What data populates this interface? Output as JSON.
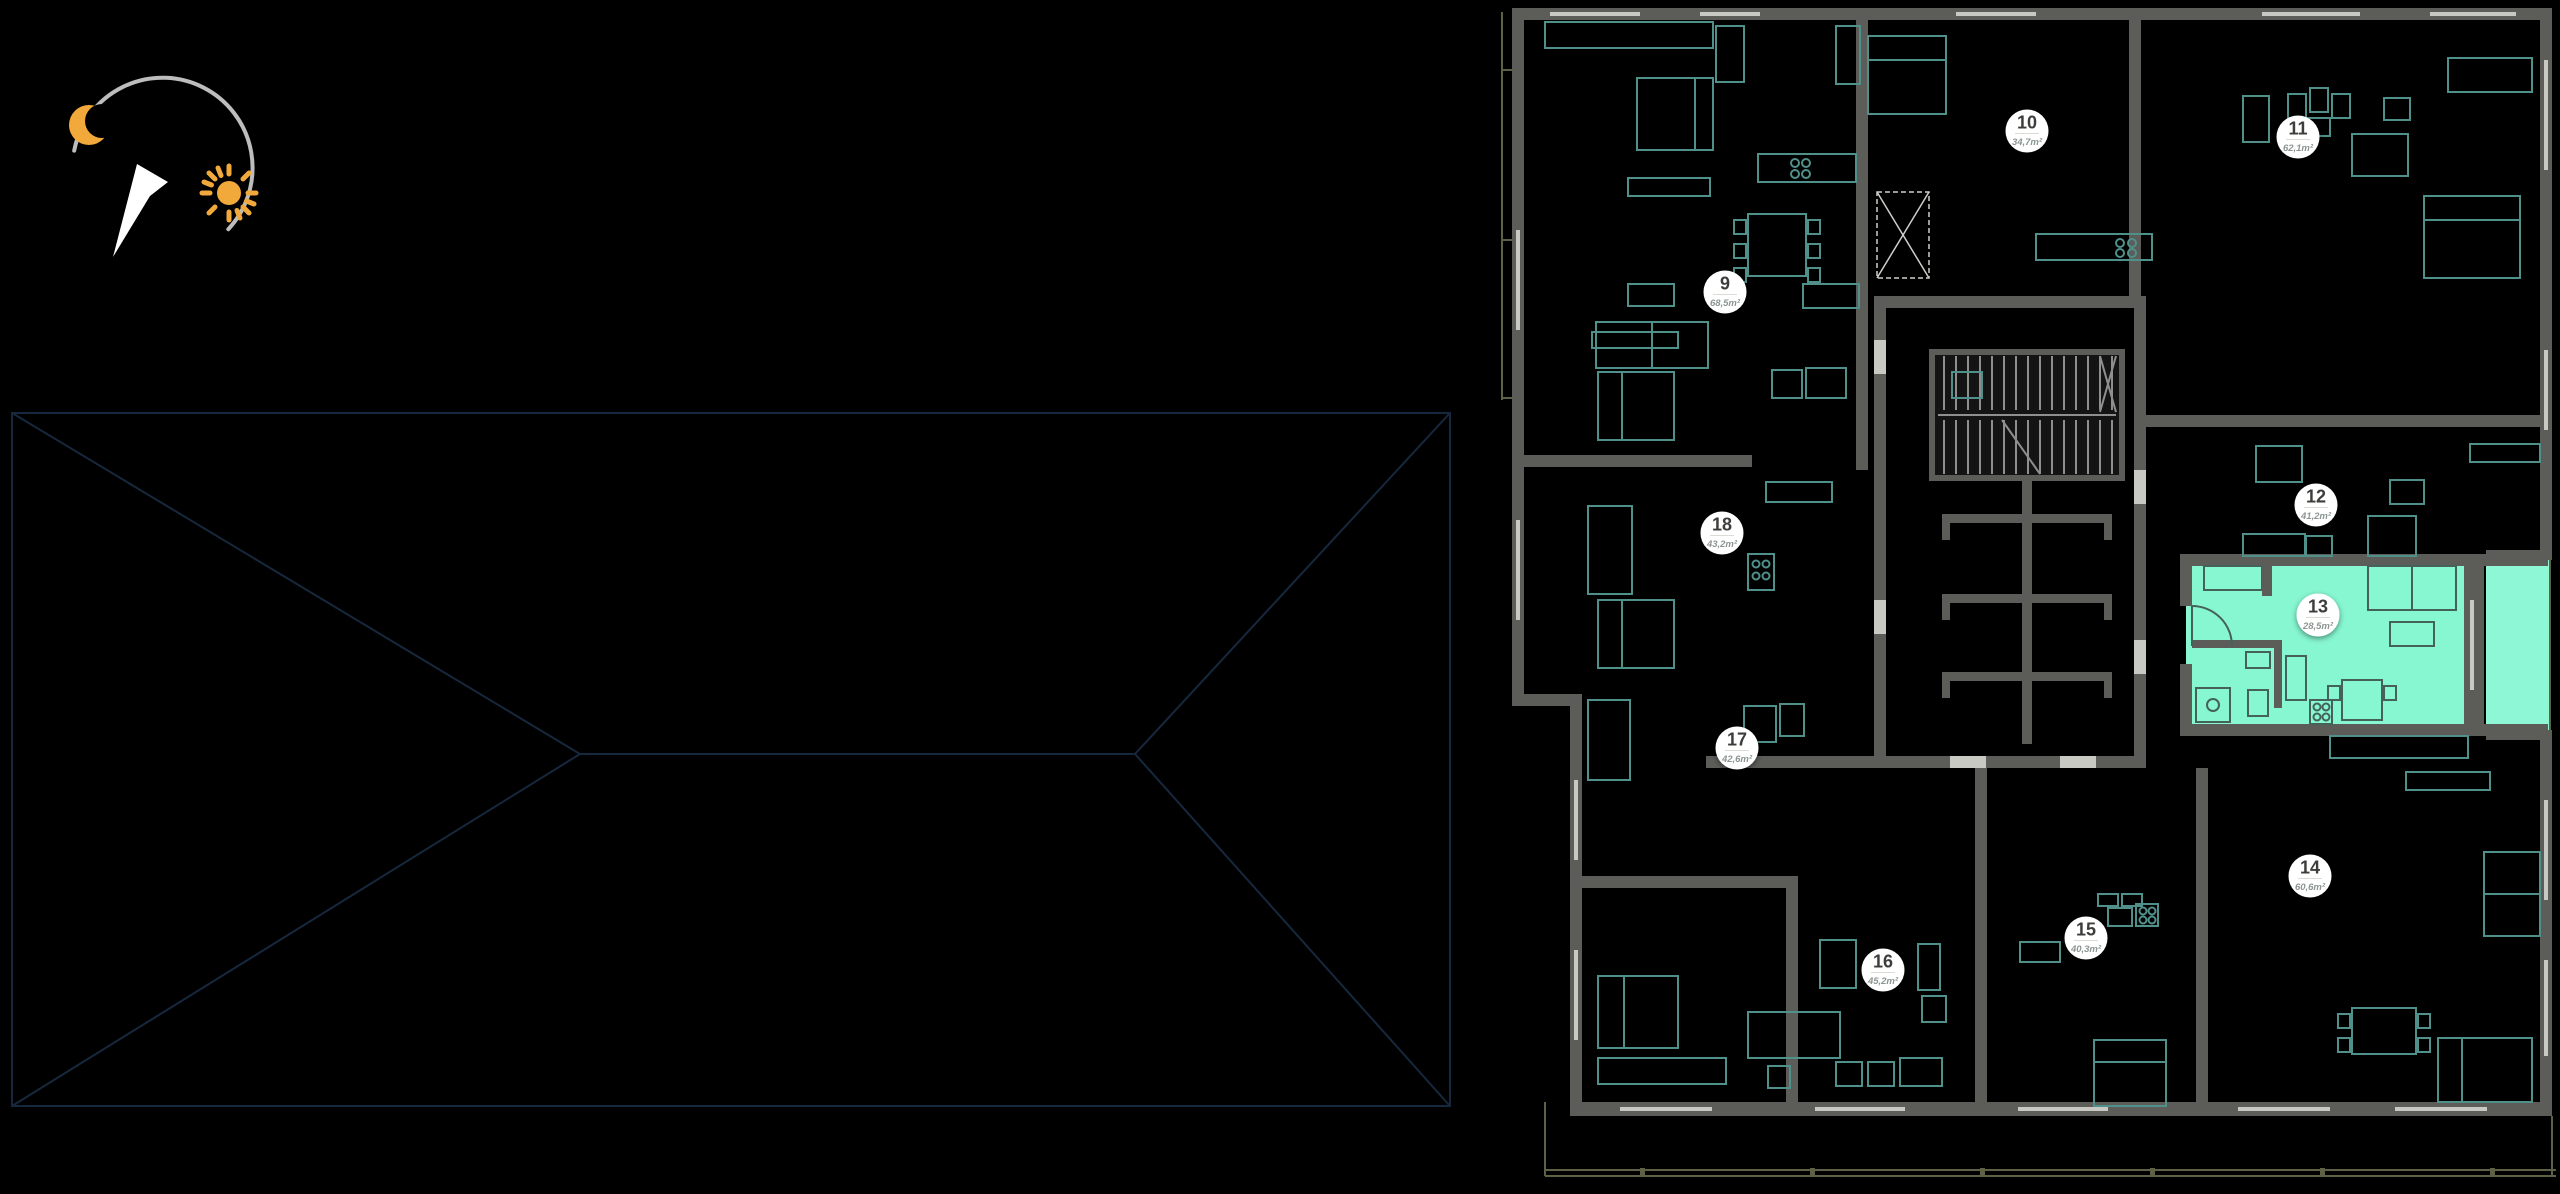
{
  "app": {
    "view": "residential-floor-plan-selector"
  },
  "colors": {
    "bg": "#000000",
    "wall": "#5c5c59",
    "window": "#c9c9c4",
    "furniture": "#4f908a",
    "furnitureDark": "#44615a",
    "stair": "#8f8f8f",
    "railing": "#5f6147",
    "roofOutline": "#16283d",
    "highlight": "#87f7d1",
    "highlightBalcony": "#8ef8d6",
    "badgeBg": "#ffffff",
    "badgeNumber": "#3d3d3b",
    "badgeArea": "#8c9691",
    "sunMoon": "#f2a93b",
    "northArrow": "#ffffff",
    "compassRing": "#bdbdbd"
  },
  "compass": {
    "moon_icon": "moon",
    "sun_icon": "sun",
    "north_arrow_icon": "north-arrow"
  },
  "floorplan": {
    "highlighted_unit": "13",
    "units": [
      {
        "number": "9",
        "area": "68,5m²",
        "x": 1725,
        "y": 292,
        "highlighted": false
      },
      {
        "number": "10",
        "area": "34,7m²",
        "x": 2027,
        "y": 131,
        "highlighted": false
      },
      {
        "number": "11",
        "area": "62,1m²",
        "x": 2298,
        "y": 137,
        "highlighted": false
      },
      {
        "number": "12",
        "area": "41,2m²",
        "x": 2316,
        "y": 505,
        "highlighted": false
      },
      {
        "number": "13",
        "area": "28,5m²",
        "x": 2318,
        "y": 615,
        "highlighted": true
      },
      {
        "number": "14",
        "area": "60,6m²",
        "x": 2310,
        "y": 876,
        "highlighted": false
      },
      {
        "number": "15",
        "area": "40,3m²",
        "x": 2086,
        "y": 938,
        "highlighted": false
      },
      {
        "number": "16",
        "area": "45,2m²",
        "x": 1883,
        "y": 970,
        "highlighted": false
      },
      {
        "number": "17",
        "area": "42,6m²",
        "x": 1737,
        "y": 748,
        "highlighted": false
      },
      {
        "number": "18",
        "area": "43,2m²",
        "x": 1722,
        "y": 533,
        "highlighted": false
      }
    ]
  }
}
